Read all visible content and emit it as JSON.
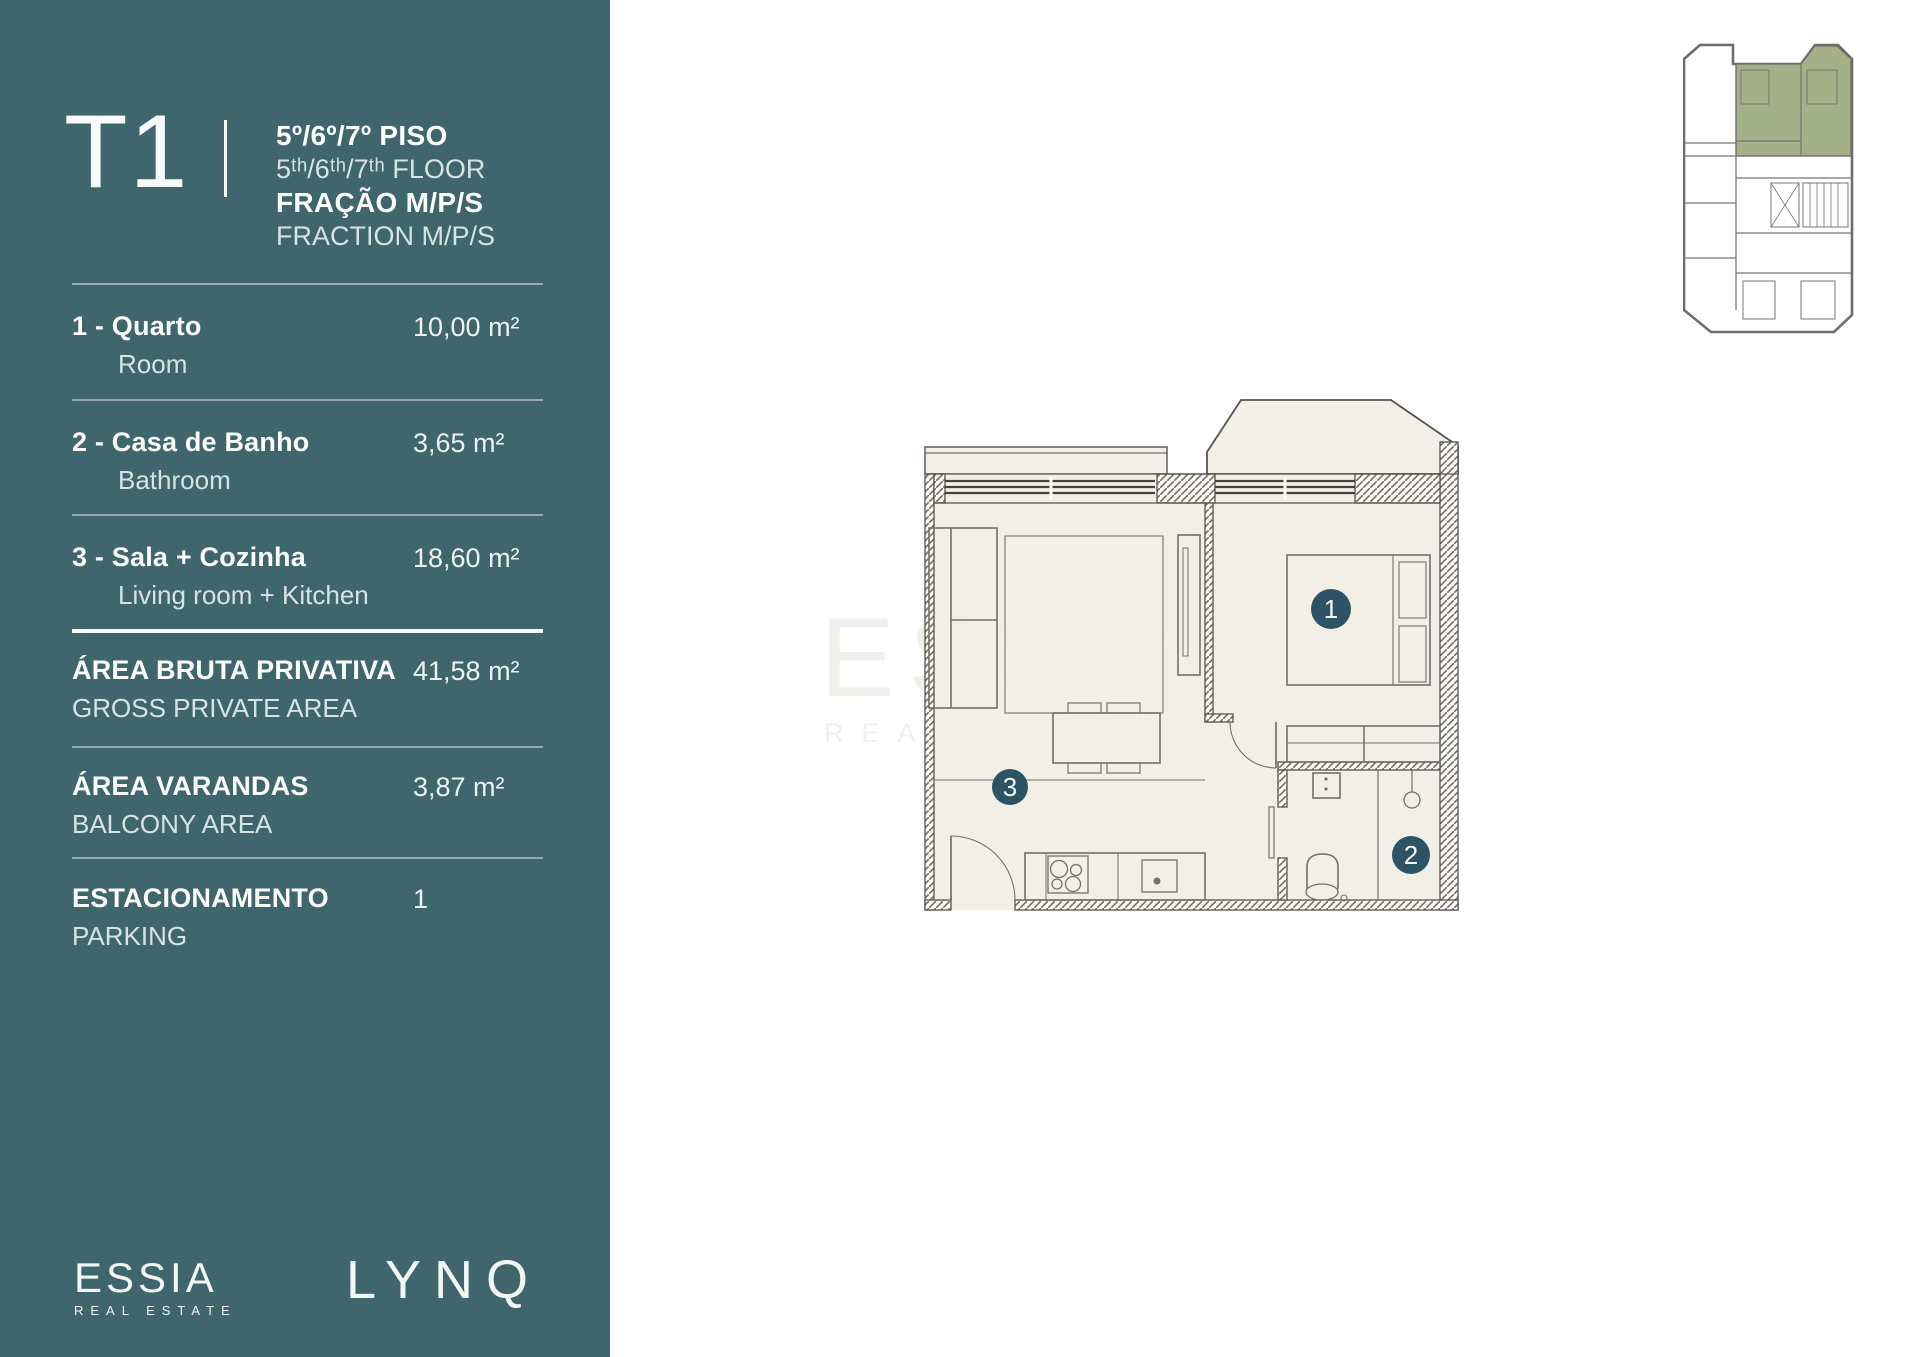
{
  "sidebar": {
    "typology": "T1",
    "header": {
      "floor_pt": "5º/6º/7º PISO",
      "floor_en": "5ᵗʰ/6ᵗʰ/7ᵗʰ FLOOR",
      "fraction_pt": "FRAÇÃO M/P/S",
      "fraction_en": "FRACTION M/P/S"
    },
    "rows": [
      {
        "label": "1 - Quarto",
        "sublabel": "Room",
        "value": "10,00 m²"
      },
      {
        "label": "2 - Casa de Banho",
        "sublabel": "Bathroom",
        "value": "3,65 m²"
      },
      {
        "label": "3 - Sala + Cozinha",
        "sublabel": "Living room + Kitchen",
        "value": "18,60 m²"
      },
      {
        "label": "ÁREA BRUTA PRIVATIVA",
        "sublabel": "GROSS PRIVATE AREA",
        "value": "41,58 m²"
      },
      {
        "label": "ÁREA VARANDAS",
        "sublabel": "BALCONY AREA",
        "value": "3,87 m²"
      },
      {
        "label": "ESTACIONAMENTO",
        "sublabel": "PARKING",
        "value": "1"
      }
    ],
    "brand": {
      "name": "ESSIA",
      "tagline": "REAL ESTATE"
    },
    "project": {
      "name": "LYNQ"
    }
  },
  "plan": {
    "badges": {
      "room": "1",
      "bathroom": "2",
      "living": "3"
    },
    "watermark": {
      "line1": "ESSIA",
      "line2": "REAL ESTATE"
    }
  },
  "colors": {
    "sidebar_teal": "#3f656d",
    "badge_teal": "#2d5464",
    "plan_cream": "#f1eee5",
    "wall_gray": "#55534e",
    "highlight_green": "#a3b088",
    "watermark_gray": "#efefec"
  }
}
